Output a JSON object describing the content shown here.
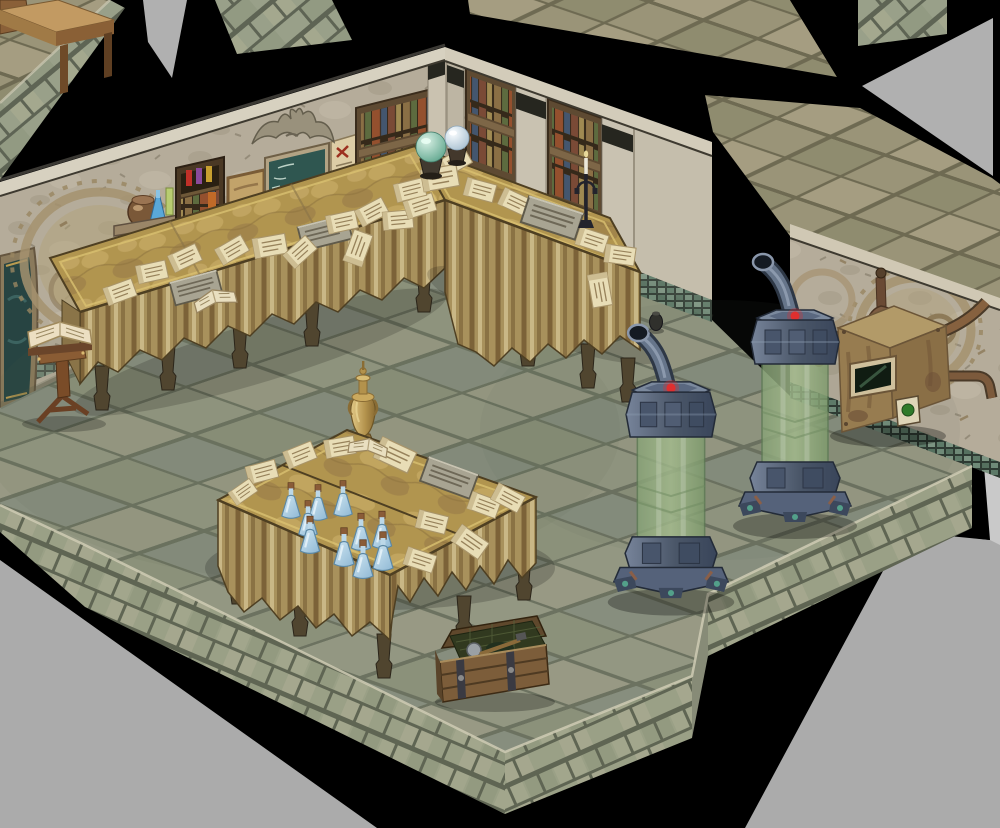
{
  "scene": {
    "type": "isometric-game-map-view",
    "label": "Isometric alchemist library laboratory room",
    "style": "2.5D RPG map (stone library with alchemy equipment)",
    "visible_text": "none"
  },
  "palette": {
    "void_gray": "#ababab",
    "shadow_black": "#000000",
    "floor_stone": "#93978a",
    "floor_grout": "#6a705e",
    "ledge_brick": "#9aa086",
    "wall_stone": "#b5ac9a",
    "wall_trim": "#d7d1c0",
    "mosaic_trim": "#5d7a68",
    "bookshelf_wood": "#5e4a32",
    "blackboard_green": "#2f5650",
    "table_gold": "#b1954f",
    "cloth_tan": "#a8915c",
    "scroll_cream": "#e8ddb6",
    "potion_blue": "#9cc4dc",
    "tank_metal": "#5a6880",
    "tank_glass_green": "#93ad7d",
    "indicator_red": "#e03030",
    "machine_rust": "#977c50",
    "gold": "#c8a85c"
  },
  "counts": {
    "potion_bottles": 10,
    "condenser_tanks": 2,
    "scroll_tables": 3,
    "crystal_balls": 2
  },
  "objects": {
    "void": {
      "label": "Gray void outside the map"
    },
    "shadow": {
      "label": "Black cast shadow / unlit gap"
    },
    "upper_platform": {
      "label": "Raised stone platform (upper left)"
    },
    "writing_desk": {
      "label": "Wooden writing desk"
    },
    "upper_walkway": {
      "label": "Stone wall-top walkway (upper right)"
    },
    "outer_brick_wall": {
      "label": "Outer brick wall top"
    },
    "nw_wall": {
      "label": "North-west library wall"
    },
    "ne_wall": {
      "label": "North-east library wall"
    },
    "gear_wall": {
      "label": "Wall with circular alchemy dial carvings"
    },
    "arch_painting": {
      "label": "Arched alcove painting"
    },
    "wall_carving": {
      "label": "Circular alchemy diagram carved into wall"
    },
    "wall_shelf": {
      "label": "Wall shelf with clay pot and glass flasks"
    },
    "apothecary_cabinet": {
      "label": "Apothecary cabinet with potions and books"
    },
    "notice_panel": {
      "label": "Framed tan notice panel"
    },
    "blackboard": {
      "label": "Chalkboard covered in formula scribbles"
    },
    "parchment_poster": {
      "label": "Pinned parchment notice with red cross"
    },
    "bookshelf_nw": {
      "label": "Bookshelves along north-west wall"
    },
    "bookshelf_ne": {
      "label": "Bookshelves along north-east wall"
    },
    "eagle_statue": {
      "label": "Stone eagle statue on the cornice"
    },
    "pillar": {
      "label": "Stone pillar with dark capital band"
    },
    "scroll_table_left": {
      "label": "Long cloth-covered study table piled with scrolls"
    },
    "scroll_table_right": {
      "label": "Cloth-covered study table piled with scrolls"
    },
    "center_table": {
      "label": "Study table with blue potion bottles and scrolls"
    },
    "scroll": {
      "label": "Parchment scroll"
    },
    "stone_tablet": {
      "label": "Engraved stone tablet"
    },
    "open_book": {
      "label": "Open book"
    },
    "crystal_ball_green": {
      "label": "Green crystal ball on stand"
    },
    "crystal_ball_white": {
      "label": "White crystal ball on stand"
    },
    "candelabra": {
      "label": "Iron candelabra with lit candle"
    },
    "lectern": {
      "label": "Wooden lectern with open book"
    },
    "golden_vase": {
      "label": "Golden amphora vase"
    },
    "potion_bottle": {
      "label": "Corked blue potion bottle"
    },
    "supply_chest": {
      "label": "Open wooden supply crate with tools"
    },
    "tank_rear": {
      "label": "Alchemic condenser tank with green glass column (rear)"
    },
    "tank_front": {
      "label": "Alchemic condenser tank with green glass column (front)"
    },
    "tank_red_light": {
      "label": "Red indicator lamp"
    },
    "furnace_machine": {
      "label": "Rusted alembic furnace with pipes into the wall"
    },
    "machine_window": {
      "label": "Dark glass porthole"
    },
    "machine_gauge": {
      "label": "Green status gauge"
    },
    "floor": {
      "label": "Green-gray stone tile floor"
    },
    "ledge": {
      "label": "Stone block ledge edge of the platform"
    },
    "small_urn": {
      "label": "Small dark urn"
    }
  }
}
